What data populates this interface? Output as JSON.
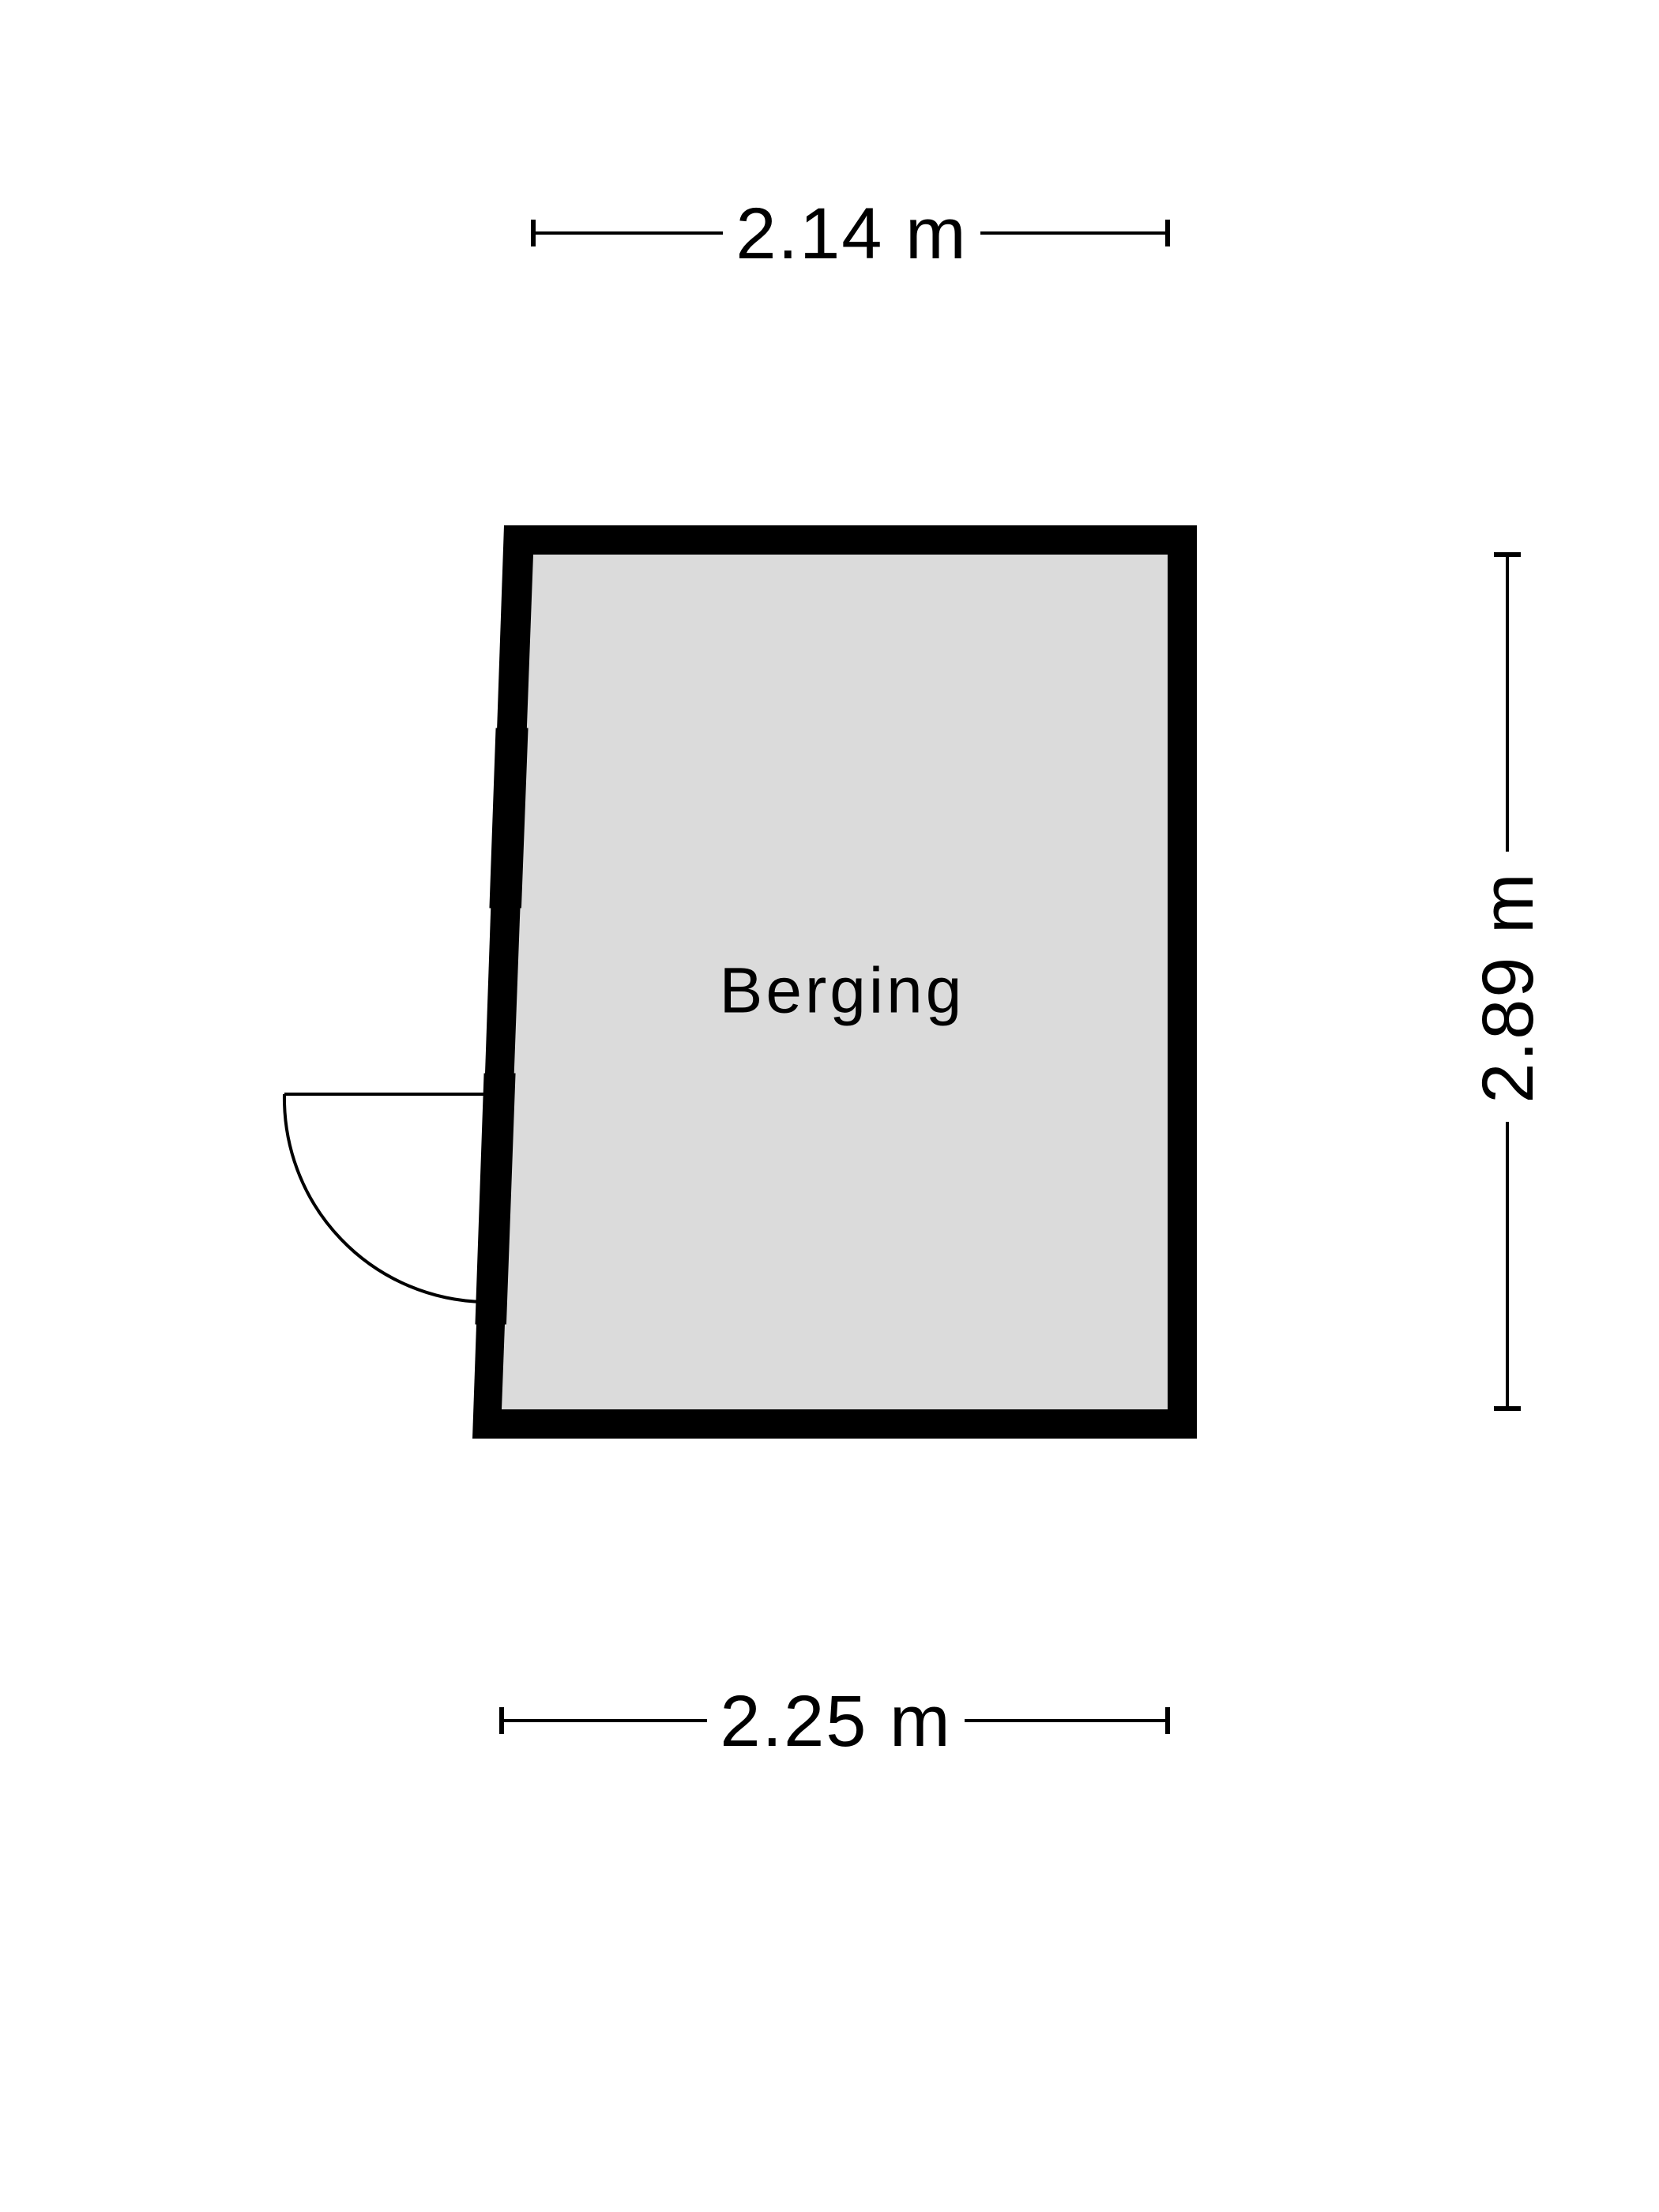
{
  "floorplan": {
    "background_color": "#ffffff",
    "wall_color": "#000000",
    "line_color": "#000000",
    "room": {
      "name": "Berging",
      "floor_color": "#dbdbdb"
    },
    "dimensions": {
      "top": "2.14 m",
      "right": "2.89 m",
      "bottom": "2.25 m"
    },
    "features": {
      "window": "window-symbol",
      "door": "door-swing-symbol"
    }
  }
}
